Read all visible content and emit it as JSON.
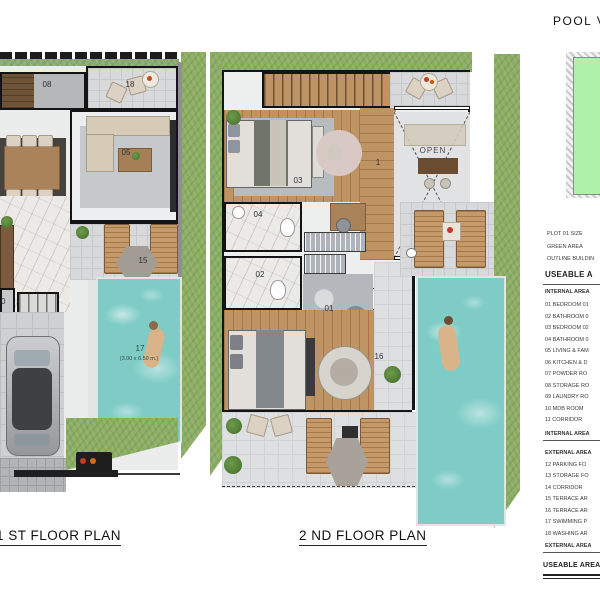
{
  "sheet": {
    "title": "POOL V"
  },
  "plan1": {
    "caption": "1 ST FLOOR PLAN",
    "labels": {
      "storage": "08",
      "washing": "18",
      "living": "05",
      "terrace": "15",
      "pool": "17",
      "pool_size": "(3.00 x 6.50 m.)",
      "mdb": "10",
      "up": "UP"
    }
  },
  "plan2": {
    "caption": "2 ND FLOOR PLAN",
    "labels": {
      "bedroom2": "03",
      "bath2": "04",
      "bath1": "02",
      "bedroom1": "01",
      "terrace": "16",
      "corridor": "1",
      "open": "OPEN",
      "down": "DN"
    }
  },
  "legend": {
    "plot_rows": [
      "PLOT 01 SIZE",
      "GREEN AREA",
      "OUTLINE BUILDIN"
    ],
    "useable_header": "USEABLE A",
    "internal_header": "INTERNAL AREA",
    "internal_items": [
      "01 BEDROOM 01",
      "02 BATHROOM 0",
      "03 BEDROOM 02",
      "04 BATHROOM 0",
      "05 LIVING & FAM",
      "06 KITCHEN & D",
      "07 POWDER RO",
      "08 STORAGE RO",
      "09 LAUNDRY RO",
      "10 MDB ROOM",
      "11 CORRIDOR"
    ],
    "internal_total": "INTERNAL AREA",
    "external_header": "EXTERNAL AREA",
    "external_items": [
      "12 PARKING FO",
      "13 STORAGE FO",
      "14 CORRIDOR",
      "15 TERRACE AR",
      "16 TERRACE AR",
      "17 SWIMMING P",
      "18 WASHING AR"
    ],
    "external_total": "EXTERNAL AREA",
    "useable_total": "USEABLE AREA T"
  },
  "colors": {
    "grass": "#8cae63",
    "pool": "#7fccc6",
    "wood": "#bf9464",
    "wall": "#161616",
    "key_green": "#aff0aa"
  }
}
